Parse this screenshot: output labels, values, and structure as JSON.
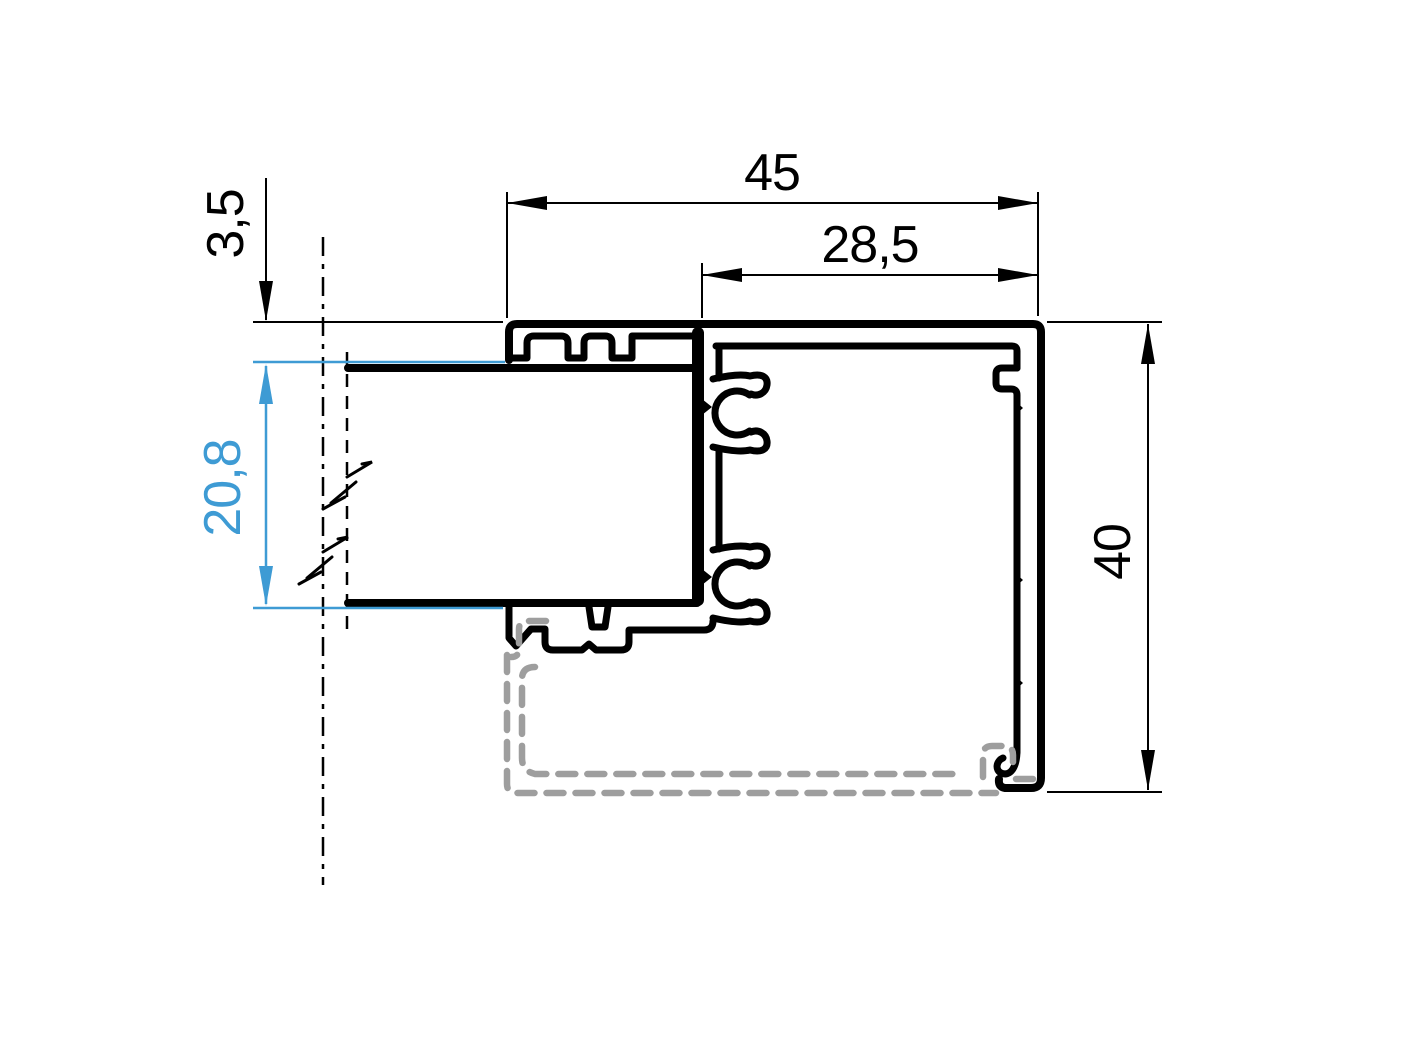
{
  "drawing": {
    "title": "Aluminium frame profile cross-section",
    "dimension_labels": {
      "overall_width": "45",
      "chamber_width": "28,5",
      "glass_offset": "3,5",
      "glazing_pocket": "20,8",
      "profile_height": "40"
    },
    "colors": {
      "outline": "#000000",
      "dimension": "#000000",
      "highlight": "#3e9bd4",
      "phantom": "#9e9e9e",
      "background": "#ffffff"
    }
  }
}
